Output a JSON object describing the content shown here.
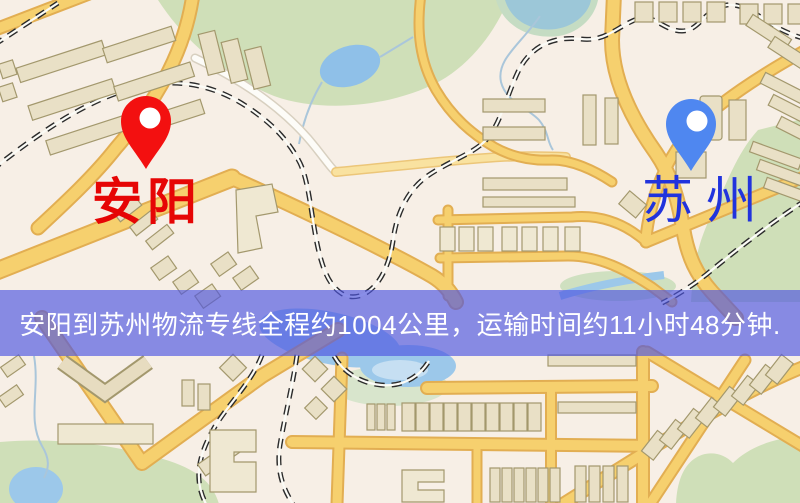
{
  "page": {
    "kind": "logistics-route-map-graphic",
    "width": 800,
    "height": 503
  },
  "banner": {
    "text": "安阳到苏州物流专线全程约1004公里，运输时间约11小时48分钟.",
    "background": "#4d55e0",
    "text_color": "#ffffff"
  },
  "markers": {
    "origin": {
      "label": "安阳",
      "label_color": "#e60505",
      "pin_icon": "red-pin-icon",
      "pin_color": "#f31010"
    },
    "destination": {
      "label": "苏州",
      "label_color": "#2133dd",
      "pin_icon": "blue-pin-icon",
      "pin_color": "#4f87f0"
    }
  },
  "route_info": {
    "origin": "安阳",
    "destination": "苏州",
    "service": "物流专线",
    "distance_text": "约1004公里",
    "duration_text": "约11小时48分钟"
  },
  "map_colors": {
    "background": "#f7efe6",
    "road_fill": "#f6d06e",
    "road_casing": "#e2ae52",
    "park_green": "#cfdfb8",
    "water_blue": "#9cc8ea",
    "building_tan": "#e9e0c6",
    "railway_dark": "#2b2b2b"
  }
}
